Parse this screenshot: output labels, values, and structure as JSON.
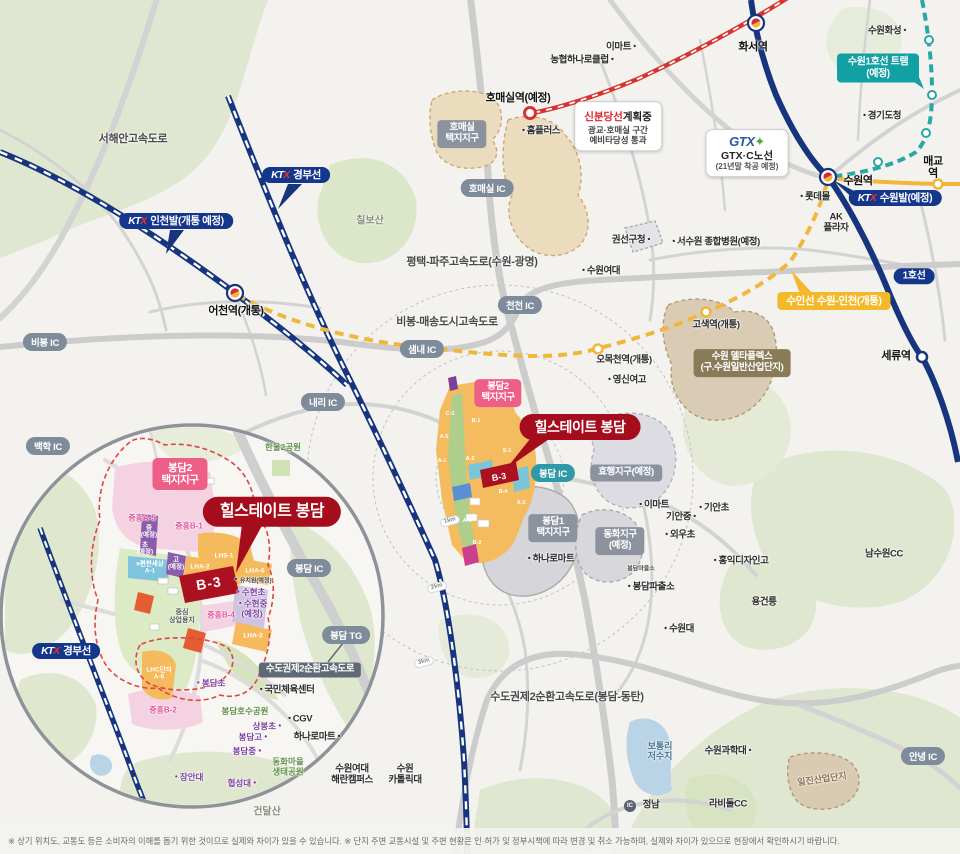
{
  "project": {
    "name": "힐스테이트 봉담",
    "block": "B-3"
  },
  "disclaimer": "※ 상기 위치도, 교통도 등은 소비자의 이해를 돕기 위한 것이므로 실제와 차이가 있을 수 있습니다.  ※ 단지 주변 교통시설 및 주변 현황은 인·허가 및 정부시책에 따라 변경 및 취소 가능하며, 실제와 차이가 있으므로 현장에서 확인하시기 바랍니다.",
  "colors": {
    "navy": "#16357e",
    "red_line": "#d63430",
    "yellow_line": "#f0b73c",
    "teal_line": "#28a7a5",
    "brand_red": "#a50d1d",
    "pink": "#ee5f88"
  },
  "gtx_box": {
    "logo": "GTX",
    "line1": "GTX·C노선",
    "line2": "(21년말 착공 예정)"
  },
  "sbd_box": {
    "t1": "신분당선",
    "t2": "계획중",
    "l1": "광교·호매실 구간",
    "l2": "예비타당성 통과"
  },
  "ic_circle": {
    "t": "IC",
    "x": 630,
    "y": 806
  },
  "pills": [
    {
      "t": "호매실 IC",
      "x": 487,
      "y": 188
    },
    {
      "t": "천천 IC",
      "x": 520,
      "y": 305
    },
    {
      "t": "샘내 IC",
      "x": 422,
      "y": 349
    },
    {
      "t": "내리 IC",
      "x": 323,
      "y": 402
    },
    {
      "t": "비봉 IC",
      "x": 45,
      "y": 342
    },
    {
      "t": "백학 IC",
      "x": 48,
      "y": 446
    },
    {
      "t": "봉담 IC",
      "x": 553,
      "y": 473,
      "teal": true
    },
    {
      "t": "봉담 IC",
      "x": 309,
      "y": 568
    },
    {
      "t": "봉담 TG",
      "x": 346,
      "y": 635
    },
    {
      "t": "안녕 IC",
      "x": 923,
      "y": 756
    }
  ],
  "ktx_badges": [
    {
      "label": "경부선",
      "x": 296,
      "y": 175
    },
    {
      "label": "인천발(개통 예정)",
      "x": 176,
      "y": 221
    },
    {
      "label": "수원발(예정)",
      "x": 895,
      "y": 198
    },
    {
      "label": "경부선",
      "x": 66,
      "y": 651
    }
  ],
  "badges": [
    {
      "t": "봉담2\n택지지구",
      "x": 498,
      "y": 393,
      "c": "pink"
    },
    {
      "t": "봉담2\n택지지구",
      "x": 180,
      "y": 474,
      "c": "pink big"
    },
    {
      "t": "호매실\n택지지구",
      "x": 462,
      "y": 134,
      "c": "gray"
    },
    {
      "t": "효행지구(예정)",
      "x": 626,
      "y": 473,
      "c": "gray"
    },
    {
      "t": "봉담1\n택지지구",
      "x": 553,
      "y": 528,
      "c": "gray"
    },
    {
      "t": "동화지구\n(예정)",
      "x": 620,
      "y": 541,
      "c": "gray"
    },
    {
      "t": "수원 델타플렉스\n(구.수원일반산업단지)",
      "x": 742,
      "y": 363,
      "c": "brown"
    },
    {
      "t": "수도권제2순환고속도로",
      "x": 310,
      "y": 670,
      "c": "slate"
    },
    {
      "t": "1호선",
      "x": 914,
      "y": 276,
      "c": "navy"
    },
    {
      "t": "수인선 수원-인천(개통)",
      "x": 834,
      "y": 301,
      "c": "yellow"
    },
    {
      "t": "수원1호선 트램(예정)",
      "x": 878,
      "y": 68,
      "c": "tram"
    }
  ],
  "points": [
    {
      "t": "서해안고속도로",
      "x": 133,
      "y": 139,
      "c": "road"
    },
    {
      "t": "칠보산",
      "x": 370,
      "y": 221,
      "c": "mtn"
    },
    {
      "t": "평택-파주고속도로(수원-광명)",
      "x": 472,
      "y": 262,
      "c": "road"
    },
    {
      "t": "비봉-매송도시고속도로",
      "x": 447,
      "y": 322,
      "c": "road"
    },
    {
      "t": "수도권제2순환고속도로(봉담-동탄)",
      "x": 567,
      "y": 697,
      "c": "road"
    },
    {
      "t": "농협하나로클럽",
      "x": 583,
      "y": 61,
      "c": "sm",
      "d": "r"
    },
    {
      "t": "이마트",
      "x": 622,
      "y": 48,
      "c": "sm",
      "d": "r"
    },
    {
      "t": "홈플러스",
      "x": 540,
      "y": 132,
      "c": "sm",
      "d": "l"
    },
    {
      "t": "권선구청",
      "x": 632,
      "y": 241,
      "c": "sm",
      "d": "r"
    },
    {
      "t": "서수원 종합병원(예정)",
      "x": 715,
      "y": 243,
      "c": "sm",
      "d": "l"
    },
    {
      "t": "수원여대",
      "x": 600,
      "y": 272,
      "c": "sm",
      "d": "l"
    },
    {
      "t": "영신여고",
      "x": 626,
      "y": 381,
      "c": "sm",
      "d": "l"
    },
    {
      "t": "수원화성",
      "x": 888,
      "y": 32,
      "c": "sm",
      "d": "r"
    },
    {
      "t": "경기도청",
      "x": 881,
      "y": 117,
      "c": "sm",
      "d": "l"
    },
    {
      "t": "롯데몰",
      "x": 814,
      "y": 198,
      "c": "sm",
      "d": "l"
    },
    {
      "t": "AK\n플라자",
      "x": 836,
      "y": 223,
      "c": "sm"
    },
    {
      "t": "매교역",
      "x": 933,
      "y": 168,
      "c": "stl"
    },
    {
      "t": "세류역",
      "x": 896,
      "y": 356,
      "c": "stl"
    },
    {
      "t": "화서역",
      "x": 753,
      "y": 47,
      "c": "stl"
    },
    {
      "t": "수원역",
      "x": 858,
      "y": 181,
      "c": "stl"
    },
    {
      "t": "호매실역(예정)",
      "x": 518,
      "y": 98,
      "c": "stl"
    },
    {
      "t": "어천역(개통)",
      "x": 236,
      "y": 311,
      "c": "stl"
    },
    {
      "t": "고색역(개통)",
      "x": 716,
      "y": 326,
      "c": "sm"
    },
    {
      "t": "오목천역(개통)",
      "x": 624,
      "y": 361,
      "c": "sm"
    },
    {
      "t": "이마트",
      "x": 653,
      "y": 506,
      "c": "sm",
      "d": "l"
    },
    {
      "t": "기안중",
      "x": 682,
      "y": 518,
      "c": "sm",
      "d": "r"
    },
    {
      "t": "기안초",
      "x": 713,
      "y": 509,
      "c": "sm",
      "d": "l"
    },
    {
      "t": "외우초",
      "x": 679,
      "y": 536,
      "c": "sm",
      "d": "l"
    },
    {
      "t": "홍익디자인고",
      "x": 740,
      "y": 562,
      "c": "sm",
      "d": "l"
    },
    {
      "t": "남수원CC",
      "x": 884,
      "y": 555,
      "c": "sm"
    },
    {
      "t": "용건릉",
      "x": 764,
      "y": 603,
      "c": "sm"
    },
    {
      "t": "수원대",
      "x": 678,
      "y": 630,
      "c": "sm",
      "d": "l"
    },
    {
      "t": "봉담파출소",
      "x": 650,
      "y": 588,
      "c": "sm",
      "d": "l"
    },
    {
      "t": "하나로마트",
      "x": 550,
      "y": 560,
      "c": "sm",
      "d": "l"
    },
    {
      "t": "봉담마을소",
      "x": 641,
      "y": 570,
      "c": "xxs"
    },
    {
      "t": "수원여대\n해란캠퍼스",
      "x": 352,
      "y": 775,
      "c": "sm"
    },
    {
      "t": "수원\n카톨릭대",
      "x": 405,
      "y": 775,
      "c": "sm"
    },
    {
      "t": "건달산",
      "x": 267,
      "y": 812,
      "c": "mtn"
    },
    {
      "t": "수원과학대",
      "x": 729,
      "y": 752,
      "c": "sm",
      "d": "r"
    },
    {
      "t": "보통리\n저수지",
      "x": 660,
      "y": 751,
      "c": "blue"
    },
    {
      "t": "라비돌CC",
      "x": 728,
      "y": 805,
      "c": "sm"
    },
    {
      "t": "정남",
      "x": 651,
      "y": 806,
      "c": "sm"
    },
    {
      "t": "일진산업단지",
      "x": 822,
      "y": 779,
      "c": "brown",
      "r": -8
    },
    {
      "t": "한울2공원",
      "x": 283,
      "y": 448,
      "c": "green"
    },
    {
      "t": "봉담호수공원",
      "x": 245,
      "y": 712,
      "c": "green"
    },
    {
      "t": "동화마을\n생태공원",
      "x": 288,
      "y": 767,
      "c": "green"
    },
    {
      "t": "국민체육센터",
      "x": 286,
      "y": 691,
      "c": "sm",
      "d": "l"
    },
    {
      "t": "CGV",
      "x": 299,
      "y": 720,
      "c": "sm",
      "d": "l"
    },
    {
      "t": "상봉초",
      "x": 268,
      "y": 727,
      "c": "purple",
      "d": "r"
    },
    {
      "t": "봉담고",
      "x": 254,
      "y": 738,
      "c": "purple",
      "d": "r"
    },
    {
      "t": "봉담중",
      "x": 248,
      "y": 752,
      "c": "purple",
      "d": "r"
    },
    {
      "t": "하나로마트",
      "x": 318,
      "y": 738,
      "c": "sm",
      "d": "r"
    },
    {
      "t": "장안대",
      "x": 188,
      "y": 778,
      "c": "purple",
      "d": "l"
    },
    {
      "t": "협성대",
      "x": 243,
      "y": 784,
      "c": "purple",
      "d": "r"
    },
    {
      "t": "봉담초",
      "x": 210,
      "y": 684,
      "c": "purple",
      "d": "l"
    },
    {
      "t": "중흥B-2",
      "x": 163,
      "y": 711,
      "c": "pinktxt"
    },
    {
      "t": "중흥C-1",
      "x": 173,
      "y": 487,
      "c": "pinktxt"
    },
    {
      "t": "중흥A-5",
      "x": 142,
      "y": 519,
      "c": "pinktxt"
    },
    {
      "t": "중흥B-1",
      "x": 189,
      "y": 527,
      "c": "pinktxt"
    },
    {
      "t": "중흥B-4",
      "x": 221,
      "y": 616,
      "c": "pinktxt"
    },
    {
      "t": "LHA-2",
      "x": 200,
      "y": 567,
      "c": "white"
    },
    {
      "t": "LHS-1",
      "x": 224,
      "y": 556,
      "c": "white"
    },
    {
      "t": "LHA-6",
      "x": 255,
      "y": 571,
      "c": "white"
    },
    {
      "t": "LHA-3",
      "x": 253,
      "y": 636,
      "c": "white"
    },
    {
      "t": "e편한세상\nA-1",
      "x": 150,
      "y": 568,
      "c": "white"
    },
    {
      "t": "중\n(예정)",
      "x": 149,
      "y": 532,
      "c": "white"
    },
    {
      "t": "초\n(예정)",
      "x": 145,
      "y": 549,
      "c": "white"
    },
    {
      "t": "고\n(예정)",
      "x": 176,
      "y": 564,
      "c": "white"
    },
    {
      "t": "중심\n상업용지",
      "x": 182,
      "y": 617,
      "c": "xs"
    },
    {
      "t": "유치원(예정)",
      "x": 252,
      "y": 581,
      "c": "xxs",
      "d": "l"
    },
    {
      "t": "수현초",
      "x": 250,
      "y": 593,
      "c": "purple",
      "d": "l"
    },
    {
      "t": "수현중\n(예정)",
      "x": 252,
      "y": 609,
      "c": "purple",
      "d": "l"
    },
    {
      "t": "LHC단지\nA-6",
      "x": 159,
      "y": 674,
      "c": "white"
    },
    {
      "t": "C-3",
      "x": 450,
      "y": 414,
      "c": "blk"
    },
    {
      "t": "A-5",
      "x": 444,
      "y": 437,
      "c": "blk"
    },
    {
      "t": "B-1",
      "x": 476,
      "y": 421,
      "c": "blk"
    },
    {
      "t": "A-1",
      "x": 442,
      "y": 461,
      "c": "blk"
    },
    {
      "t": "A-2",
      "x": 470,
      "y": 459,
      "c": "blk"
    },
    {
      "t": "S-1",
      "x": 507,
      "y": 451,
      "c": "blk"
    },
    {
      "t": "B-4",
      "x": 503,
      "y": 492,
      "c": "blk"
    },
    {
      "t": "A-3",
      "x": 521,
      "y": 503,
      "c": "blk"
    },
    {
      "t": "A-4",
      "x": 467,
      "y": 521,
      "c": "blk"
    },
    {
      "t": "B-2",
      "x": 477,
      "y": 543,
      "c": "blk"
    },
    {
      "t": "B-3",
      "x": 499,
      "y": 477,
      "c": "blk3",
      "r": -10
    },
    {
      "t": "B-3",
      "x": 209,
      "y": 584,
      "c": "blk3b",
      "r": -9
    },
    {
      "t": "1km",
      "x": 450,
      "y": 521,
      "c": "km",
      "r": -15
    },
    {
      "t": "2km",
      "x": 437,
      "y": 587,
      "c": "km",
      "r": -15
    },
    {
      "t": "3km",
      "x": 424,
      "y": 662,
      "c": "km",
      "r": -15
    }
  ]
}
